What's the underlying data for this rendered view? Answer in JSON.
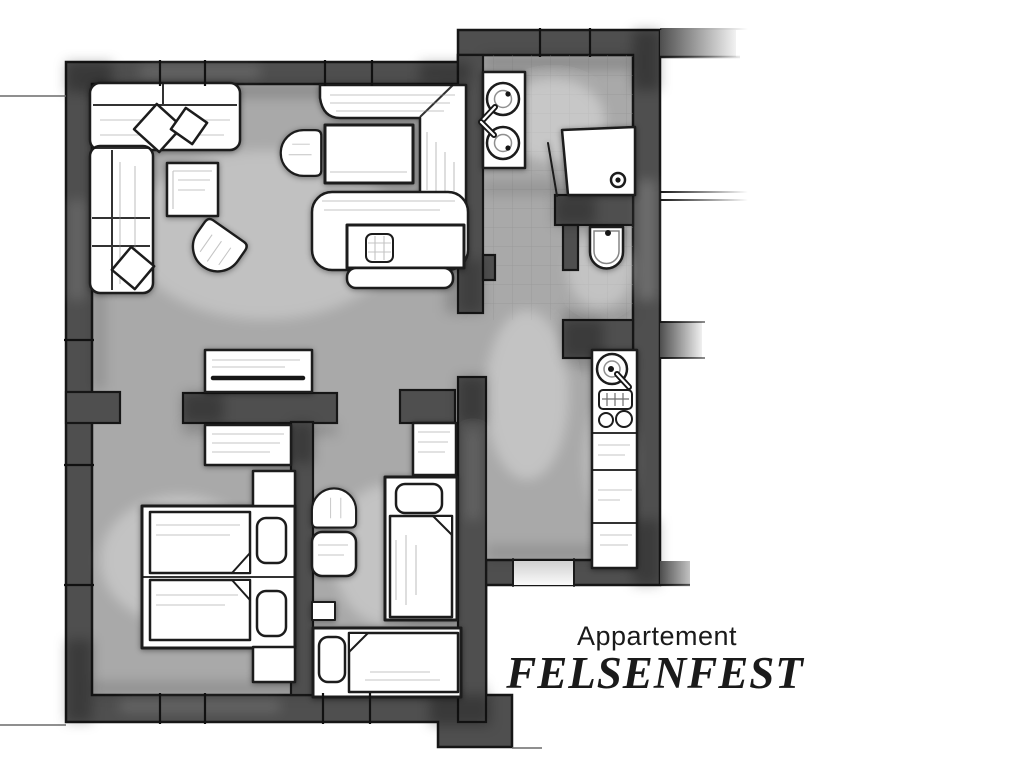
{
  "title": {
    "line1": "Appartement",
    "line2": "FELSENFEST"
  },
  "colors": {
    "background": "#ffffff",
    "wall": "#4f4f4f",
    "floor": "#a9a9a9",
    "tile_line": "#8f8f8f",
    "outline": "#161616",
    "furniture_fill": "#ffffff",
    "text": "#1a1a1a"
  },
  "floorplan": {
    "type": "apartment-floor-plan",
    "rooms": [
      {
        "id": "living-room",
        "furniture": [
          "corner-sofa",
          "throw-cushions",
          "coffee-table",
          "tub-chair",
          "double-bed",
          "bench",
          "sideboard"
        ]
      },
      {
        "id": "bathroom",
        "furniture": [
          "double-washbasin",
          "shower"
        ]
      },
      {
        "id": "wc",
        "furniture": [
          "toilet"
        ]
      },
      {
        "id": "kitchenette",
        "furniture": [
          "sink",
          "hob",
          "worktop"
        ]
      },
      {
        "id": "bedroom",
        "furniture": [
          "double-bed",
          "pillows",
          "nightstand-top",
          "nightstand-bottom",
          "wardrobe"
        ]
      },
      {
        "id": "kids-room",
        "furniture": [
          "single-bed-vertical",
          "single-bed-horizontal",
          "wardrobe",
          "arch-chair",
          "side-table",
          "shelf"
        ]
      },
      {
        "id": "hallway",
        "furniture": []
      }
    ]
  }
}
